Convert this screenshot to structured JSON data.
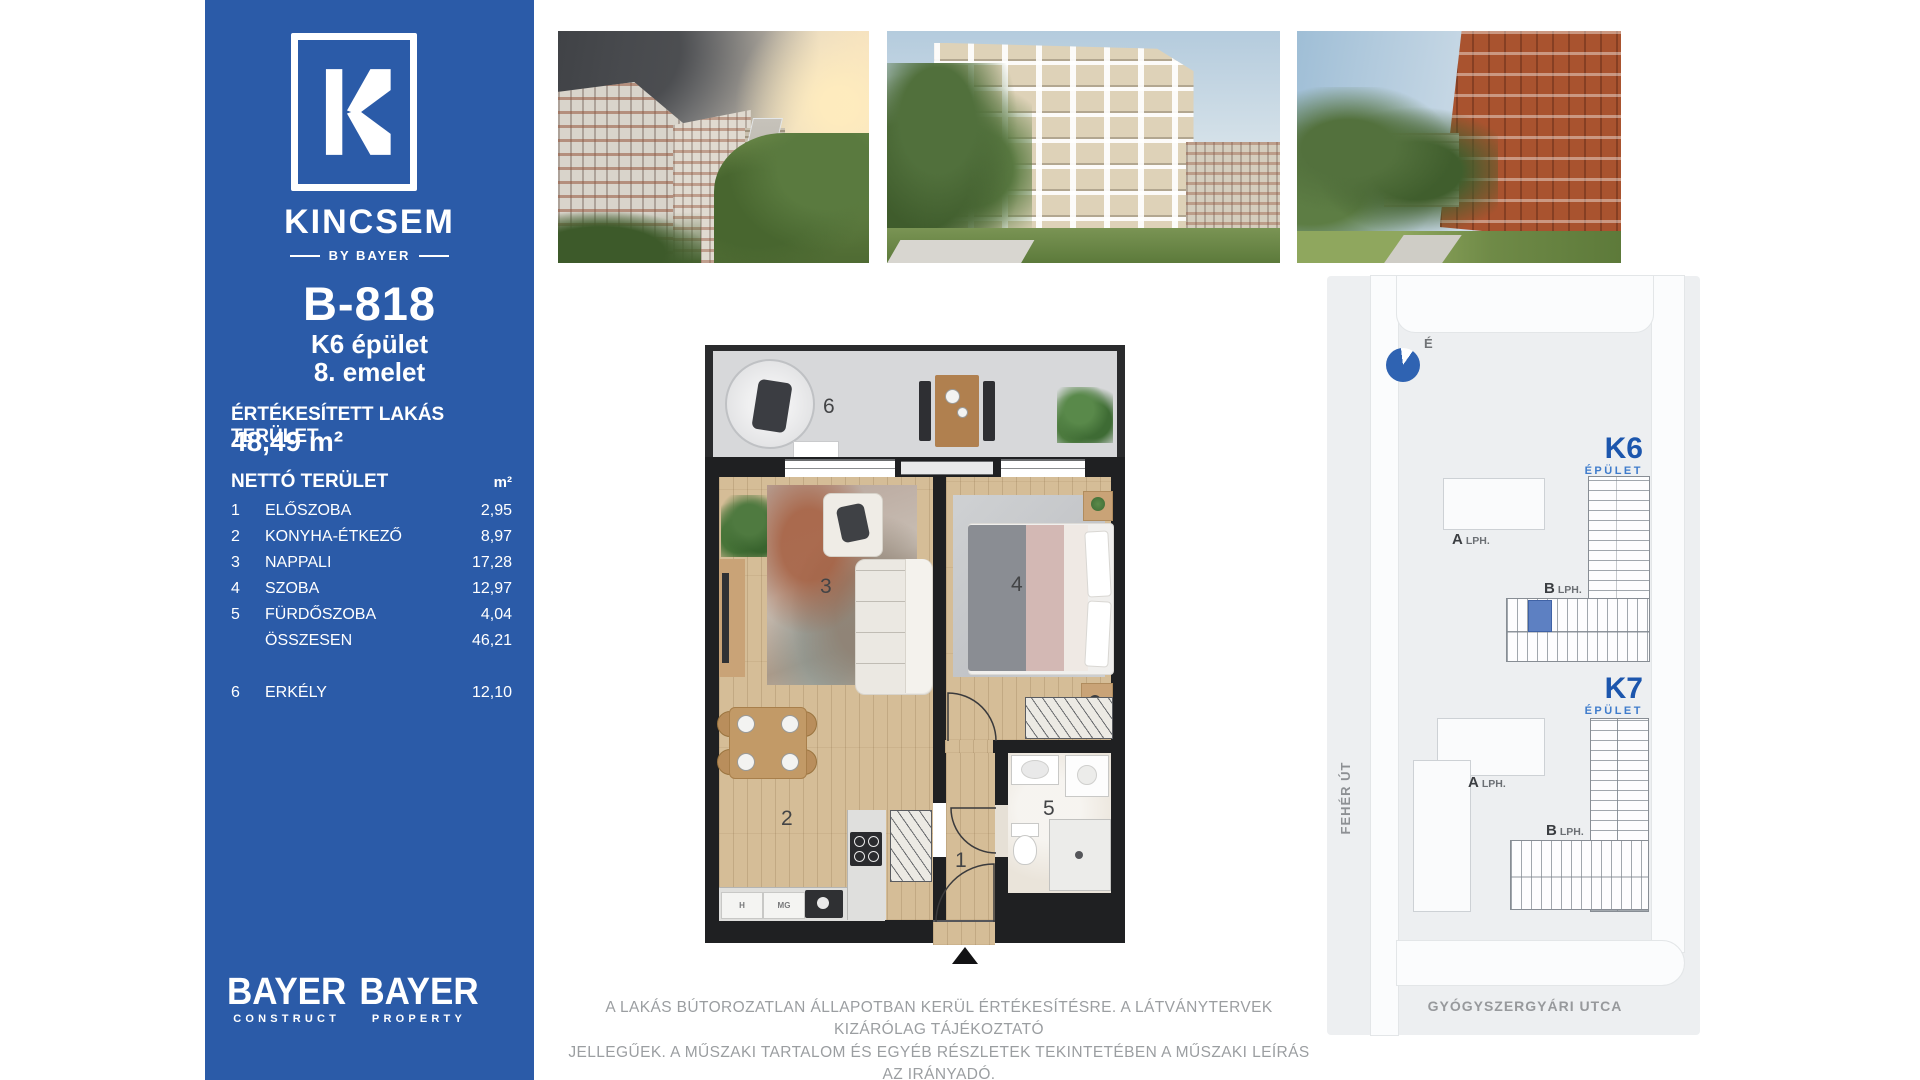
{
  "brand": {
    "logo_letter": "K",
    "name": "KINCSEM",
    "byline": "BY BAYER"
  },
  "unit": {
    "id": "B-818",
    "building": "K6 épület",
    "floor": "8. emelet"
  },
  "sold_area": {
    "label": "ÉRTÉKESÍTETT LAKÁS TERÜLET",
    "value": "48,49 m²"
  },
  "area_table": {
    "title": "NETTÓ TERÜLET",
    "unit": "m²",
    "rows": [
      {
        "num": "1",
        "label": "ELŐSZOBA",
        "value": "2,95"
      },
      {
        "num": "2",
        "label": "KONYHA-ÉTKEZŐ",
        "value": "8,97"
      },
      {
        "num": "3",
        "label": "NAPPALI",
        "value": "17,28"
      },
      {
        "num": "4",
        "label": "SZOBA",
        "value": "12,97"
      },
      {
        "num": "5",
        "label": "FÜRDŐSZOBA",
        "value": "4,04"
      },
      {
        "num": "",
        "label": "ÖSSZESEN",
        "value": "46,21"
      },
      {
        "num": "6",
        "label": "ERKÉLY",
        "value": "12,10"
      }
    ]
  },
  "footer_logos": [
    {
      "name": "BAYER",
      "division": "CONSTRUCT"
    },
    {
      "name": "BAYER",
      "division": "PROPERTY"
    }
  ],
  "disclaimer": {
    "line1": "A LAKÁS BÚTOROZATLAN ÁLLAPOTBAN KERÜL ÉRTÉKESÍTÉSRE. A LÁTVÁNYTERVEK KIZÁRÓLAG TÁJÉKOZTATÓ",
    "line2": "JELLEGŰEK. A MŰSZAKI TARTALOM ÉS EGYÉB RÉSZLETEK TEKINTETÉBEN A MŰSZAKI LEÍRÁS AZ IRÁNYADÓ."
  },
  "floor_plan": {
    "rooms": {
      "hall": "1",
      "kitchen": "2",
      "living": "3",
      "bedroom": "4",
      "bath": "5",
      "balcony": "6"
    },
    "labels": {
      "h": "H",
      "mg": "MG"
    }
  },
  "site_map": {
    "compass": "É",
    "street_left": "FEHÉR ÚT",
    "street_bottom": "GYÓGYSZERGYÁRI UTCA",
    "k6": {
      "id": "K6",
      "type": "ÉPÜLET",
      "stair_a": "A",
      "stair_a_suffix": "LPH.",
      "stair_b": "B",
      "stair_b_suffix": "LPH."
    },
    "k7": {
      "id": "K7",
      "type": "ÉPÜLET",
      "stair_a": "A",
      "stair_a_suffix": "LPH.",
      "stair_b": "B",
      "stair_b_suffix": "LPH."
    }
  },
  "colors": {
    "sidebar_blue": "#2b5ba8",
    "accent_blue": "#1f5bb0",
    "unit_highlight": "#5d80c2"
  }
}
